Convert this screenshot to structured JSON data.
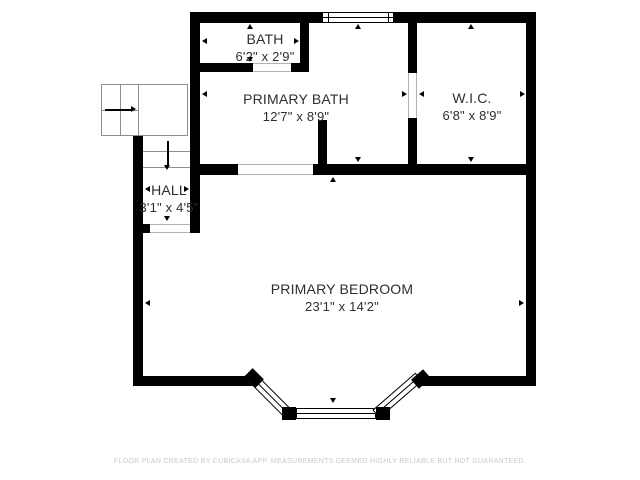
{
  "colors": {
    "background": "#ffffff",
    "wall": "#000000",
    "stair_line": "#8e8e8e",
    "opening_line": "#b3b3b3",
    "room_text": "#2e2e2e",
    "footer_text": "#c9c9c9"
  },
  "rooms": {
    "bath": {
      "name": "BATH",
      "dims": "6'2\" x 2'9\""
    },
    "primary_bath": {
      "name": "PRIMARY BATH",
      "dims": "12'7\" x 8'9\""
    },
    "wic": {
      "name": "W.I.C.",
      "dims": "6'8\" x 8'9\""
    },
    "hall": {
      "name": "HALL",
      "dims": "3'1\" x 4'5\""
    },
    "primary_bedroom": {
      "name": "PRIMARY BEDROOM",
      "dims": "23'1\" x 14'2\""
    }
  },
  "footer": {
    "disclaimer": "FLOOR PLAN CREATED BY CUBICASA APP. MEASUREMENTS DEEMED HIGHLY RELIABLE BUT NOT GUARANTEED."
  },
  "icons": {
    "stair_direction_right": "solid right arrow",
    "stair_direction_down": "solid down arrow",
    "dimension_marker": "small solid triangle pointing at wall"
  }
}
